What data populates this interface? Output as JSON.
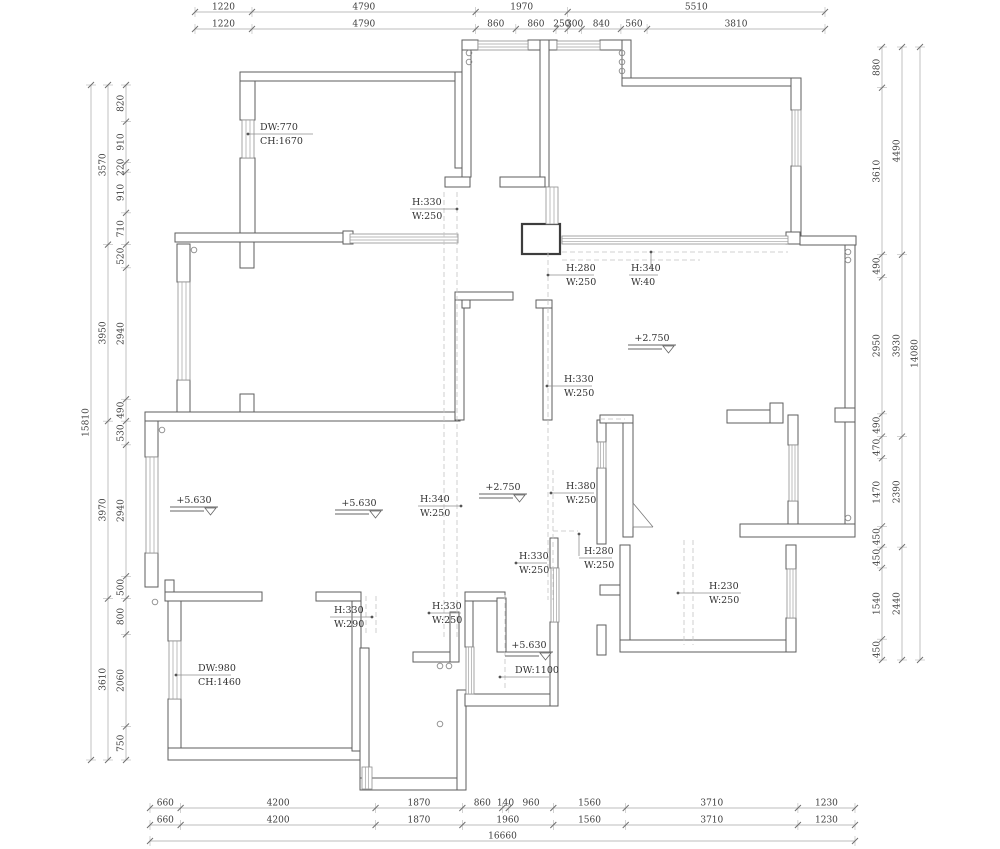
{
  "drawing": {
    "kind": "floor-plan",
    "units": "mm",
    "wall_color": "#5e5e5e",
    "dim_color": "#3c3c3c"
  },
  "dimension_chains": [
    {
      "id": "top-row-1",
      "axis": "h",
      "pos": 12,
      "from": 195,
      "to": 825,
      "values": [
        1220,
        4790,
        1970,
        5510
      ]
    },
    {
      "id": "top-row-2",
      "axis": "h",
      "pos": 29,
      "from": 195,
      "to": 825,
      "values": [
        1220,
        4790,
        860,
        860,
        250,
        300,
        840,
        560,
        3810
      ]
    },
    {
      "id": "left-outer",
      "axis": "v",
      "pos": 91,
      "from": 85,
      "to": 760,
      "values": [
        15810
      ]
    },
    {
      "id": "left-mid",
      "axis": "v",
      "pos": 108,
      "from": 85,
      "to": 760,
      "values": [
        3570,
        3950,
        3970,
        3610
      ]
    },
    {
      "id": "left-inner",
      "axis": "v",
      "pos": 126,
      "from": 85,
      "to": 760,
      "values": [
        820,
        910,
        220,
        910,
        710,
        520,
        2940,
        490,
        530,
        2940,
        500,
        800,
        2060,
        750
      ]
    },
    {
      "id": "right-inner",
      "axis": "v",
      "pos": 882,
      "from": 47,
      "to": 660,
      "values": [
        880,
        3610,
        490,
        2950,
        490,
        470,
        1470,
        450,
        450,
        1540,
        450
      ]
    },
    {
      "id": "right-mid",
      "axis": "v",
      "pos": 902,
      "from": 47,
      "to": 660,
      "values": [
        4490,
        3930,
        2390,
        2440
      ]
    },
    {
      "id": "right-outer",
      "axis": "v",
      "pos": 920,
      "from": 47,
      "to": 660,
      "values": [
        14080
      ]
    },
    {
      "id": "bottom-row-1",
      "axis": "h",
      "pos": 808,
      "from": 150,
      "to": 855,
      "values": [
        660,
        4200,
        1870,
        860,
        140,
        960,
        1560,
        3710,
        1230
      ]
    },
    {
      "id": "bottom-row-2",
      "axis": "h",
      "pos": 825,
      "from": 150,
      "to": 855,
      "values": [
        660,
        4200,
        1870,
        1960,
        1560,
        3710,
        1230
      ]
    },
    {
      "id": "bottom-total",
      "axis": "h",
      "pos": 841,
      "from": 150,
      "to": 855,
      "values": [
        16660
      ]
    }
  ],
  "annotations": [
    {
      "l1": "DW:770",
      "l2": "CH:1670",
      "tx": 260,
      "ty": 130,
      "rule": [
        248,
        313,
        134
      ],
      "dot": [
        248,
        134
      ]
    },
    {
      "l1": "H:330",
      "l2": "W:250",
      "tx": 412,
      "ty": 205,
      "rule": [
        410,
        457,
        209
      ],
      "dot": [
        457,
        209
      ]
    },
    {
      "l1": "H:280",
      "l2": "W:250",
      "tx": 566,
      "ty": 271,
      "rule": [
        548,
        594,
        275
      ],
      "dot": [
        548,
        275
      ]
    },
    {
      "l1": "H:340",
      "l2": "W:40",
      "tx": 631,
      "ty": 271,
      "rule": [
        629,
        658,
        275
      ],
      "vline": [
        651,
        252,
        268
      ],
      "vdot": [
        651,
        252
      ]
    },
    {
      "l1": "H:330",
      "l2": "W:250",
      "tx": 564,
      "ty": 382,
      "rule": [
        547,
        592,
        386
      ],
      "dot": [
        547,
        386
      ]
    },
    {
      "l1": "H:340",
      "l2": "W:250",
      "tx": 420,
      "ty": 502,
      "rule": [
        418,
        461,
        506
      ],
      "dot": [
        461,
        506
      ]
    },
    {
      "l1": "H:380",
      "l2": "W:250",
      "tx": 566,
      "ty": 489,
      "rule": [
        551,
        594,
        493
      ],
      "dot": [
        551,
        493
      ]
    },
    {
      "l1": "H:330",
      "l2": "W:250",
      "tx": 519,
      "ty": 559,
      "rule": [
        516,
        547,
        563
      ],
      "dot": [
        516,
        563
      ]
    },
    {
      "l1": "H:280",
      "l2": "W:250",
      "tx": 584,
      "ty": 554,
      "rule": [
        579,
        612,
        558
      ],
      "vline": [
        579,
        534,
        556
      ],
      "vdot": [
        579,
        534
      ]
    },
    {
      "l1": "H:230",
      "l2": "W:250",
      "tx": 709,
      "ty": 589,
      "rule": [
        678,
        741,
        593
      ],
      "dot": [
        678,
        593
      ]
    },
    {
      "l1": "H:330",
      "l2": "W:290",
      "tx": 334,
      "ty": 613,
      "rule": [
        330,
        372,
        617
      ],
      "dot": [
        372,
        617
      ]
    },
    {
      "l1": "H:330",
      "l2": "W:250",
      "tx": 432,
      "ty": 609,
      "rule": [
        429,
        461,
        613
      ],
      "dot": [
        429,
        613
      ]
    },
    {
      "l1": "DW:1100",
      "l2": "",
      "tx": 515,
      "ty": 673,
      "rule": [
        500,
        549,
        677
      ],
      "dot": [
        500,
        677
      ]
    },
    {
      "l1": "DW:980",
      "l2": "CH:1460",
      "tx": 198,
      "ty": 671,
      "rule": [
        176,
        231,
        675
      ],
      "dot": [
        176,
        675
      ]
    }
  ],
  "elevation_markers": [
    {
      "label": "+2.750",
      "x": 652,
      "y": 341
    },
    {
      "label": "+5.630",
      "x": 194,
      "y": 503
    },
    {
      "label": "+5.630",
      "x": 359,
      "y": 506
    },
    {
      "label": "+2.750",
      "x": 503,
      "y": 490
    },
    {
      "label": "+5.630",
      "x": 529,
      "y": 648
    }
  ]
}
